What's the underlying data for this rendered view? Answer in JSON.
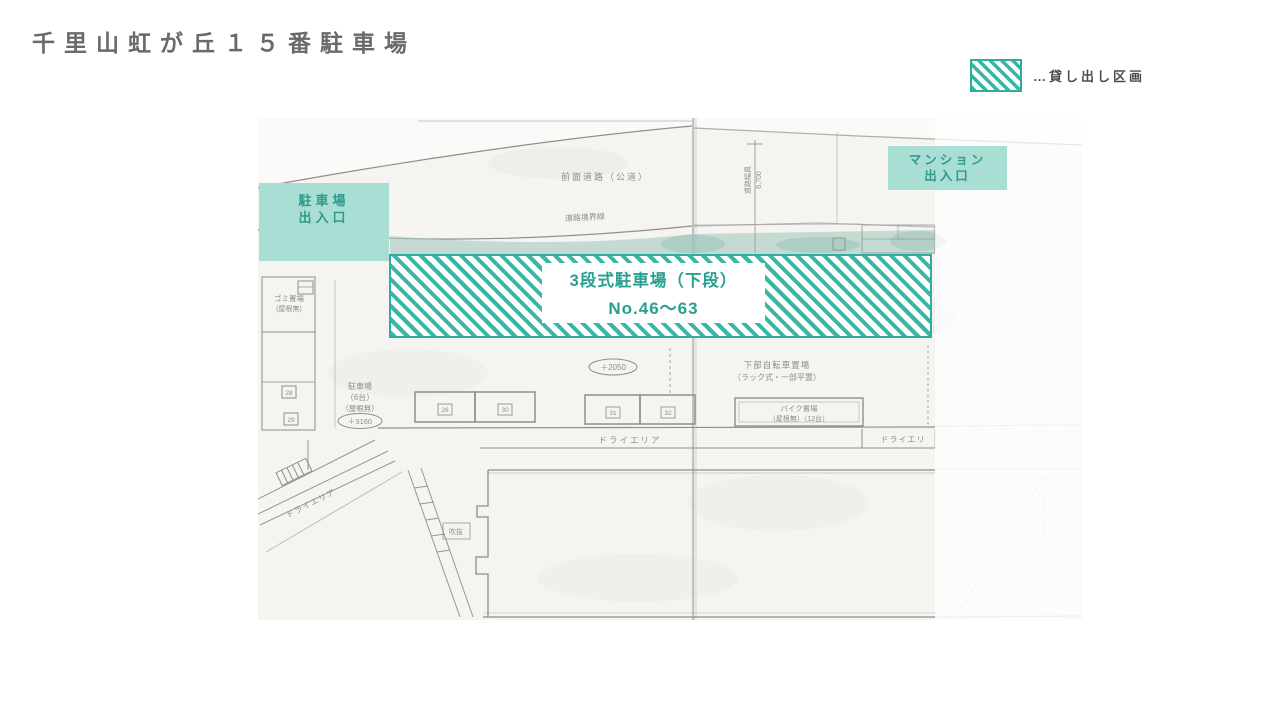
{
  "title": "千里山虹が丘１５番駐車場",
  "legend": {
    "label": "…貸し出し区画"
  },
  "overlays": {
    "parking_entrance": {
      "line1": "駐車場",
      "line2": "出入口"
    },
    "mansion_entrance": {
      "line1": "マンション",
      "line2": "出入口"
    },
    "rental_area": {
      "line1": "3段式駐車場（下段）",
      "line2": "No.46～63"
    }
  },
  "plan_labels": {
    "front_road": "前面道路（公道）",
    "road_boundary": "道路境界線",
    "road_width_label": "道路幅員",
    "road_width_value": "6,700",
    "garbage_line1": "ゴミ置場",
    "garbage_line2": "(屋根無)",
    "small_lot_line1": "駐車場",
    "small_lot_line2": "（6台）",
    "small_lot_line3": "（屋根無）",
    "small_lot_level": "＋3160",
    "center_level": "＋2050",
    "bicycle_line1": "下部自転車置場",
    "bicycle_line2": "（ラック式・一部平置）",
    "bike_line1": "バイク置場",
    "bike_line2": "（屋根無）（12台）",
    "dry_area_center": "ドライエリア",
    "dry_area_right": "ドライエリ",
    "dry_area_left": "ドライエリア",
    "void_label": "吹抜",
    "stall_26": "26",
    "stall_30": "30",
    "stall_31": "31",
    "stall_32": "32",
    "stall_28": "28",
    "stall_29": "29"
  },
  "colors": {
    "hatch_teal": "#39b6a5",
    "hatch_border": "#2dae9e",
    "entrance_fill": "#a9ded4",
    "entrance_text": "#2f9a8a",
    "title_gray": "#6a6a6a"
  }
}
